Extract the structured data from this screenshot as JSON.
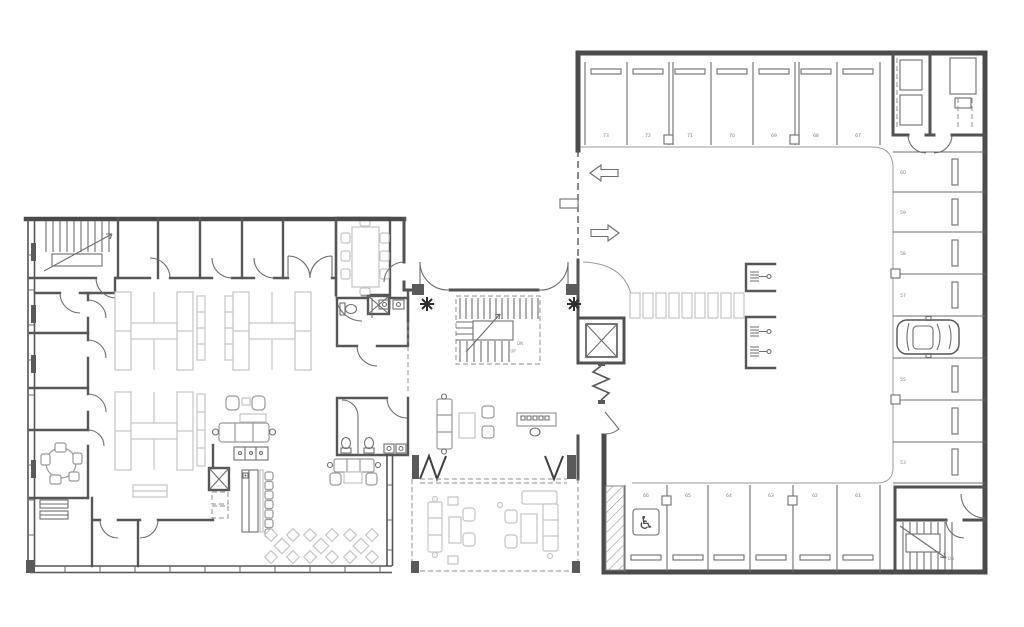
{
  "drawing": {
    "type": "architectural-floor-plan",
    "background": "#ffffff",
    "colors": {
      "wall_dark": "#4b4b4b",
      "wall_mid": "#575757",
      "line_thin": "#6e6e6e",
      "line_light": "#9b9b9b",
      "furniture_gray": "#9a9a9a",
      "furniture_light": "#c5c5c5",
      "label_gray": "#7b7b7b"
    }
  },
  "parking": {
    "top_row_stalls": [
      "73",
      "72",
      "71",
      "70",
      "69",
      "68",
      "67"
    ],
    "right_column_stalls": [
      "60",
      "59",
      "58",
      "57",
      "56",
      "55",
      "54",
      "53"
    ],
    "bottom_row_stalls": [
      "66",
      "65",
      "64",
      "63",
      "62",
      "61"
    ]
  },
  "labels": {
    "lobby_stair_down": "DN",
    "lobby_stair_up": "UP",
    "garage_stair_down": "DN"
  },
  "icons": {
    "wheelchair": "♿"
  }
}
